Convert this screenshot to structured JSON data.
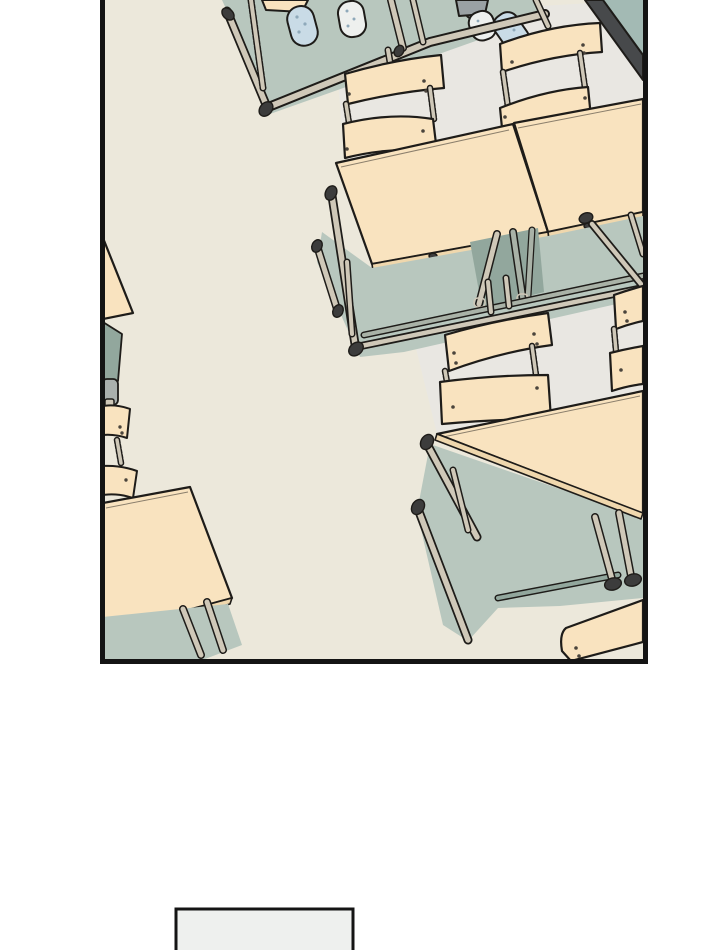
{
  "page": {
    "width": 720,
    "height": 950,
    "background": "#ffffff"
  },
  "colors": {
    "page_bg": "#ffffff",
    "outline": "#1e1c19",
    "panel_border": "#141414",
    "floor_cream": "#ece8db",
    "floor_light": "#e9e7e2",
    "furniture_cream": "#f9e3bf",
    "furniture_edge": "#efd7ad",
    "sage": "#b8c7be",
    "sage_dark": "#92a79d",
    "leg_tan": "#cfc8b8",
    "leg_gray": "#a9b2a7",
    "cap_dark": "#3c3c3c",
    "bar_dark": "#47494b",
    "teal_corner": "#a3bab4",
    "slipper_blue": "#c9dbe6",
    "slipper_dot": "#8fa9ba",
    "white_soft": "#eef0ee",
    "pant_gray": "#9aa1a4",
    "metal_gray": "#aab0ad",
    "rivet": "#4a443c"
  },
  "panels": {
    "main": {
      "left": 100,
      "top": 0,
      "width": 548,
      "height": 664,
      "border_px": 5,
      "kind": "classroom-scene"
    },
    "next": {
      "left": 176,
      "top": 909,
      "width": 177,
      "visible_height": 41,
      "border_px": 3,
      "kind": "empty-panel-start"
    }
  },
  "scene": {
    "description": "overhead diagonal view of a classroom: paired cream school desks with slatted chairs, sage floor shadows, and two students' feet in slippers at the top edge",
    "objects": [
      "school-desk",
      "chair-backrest",
      "floor-shadow",
      "desk-leg",
      "slipper",
      "trouser-leg",
      "wall-corner-edge"
    ]
  }
}
